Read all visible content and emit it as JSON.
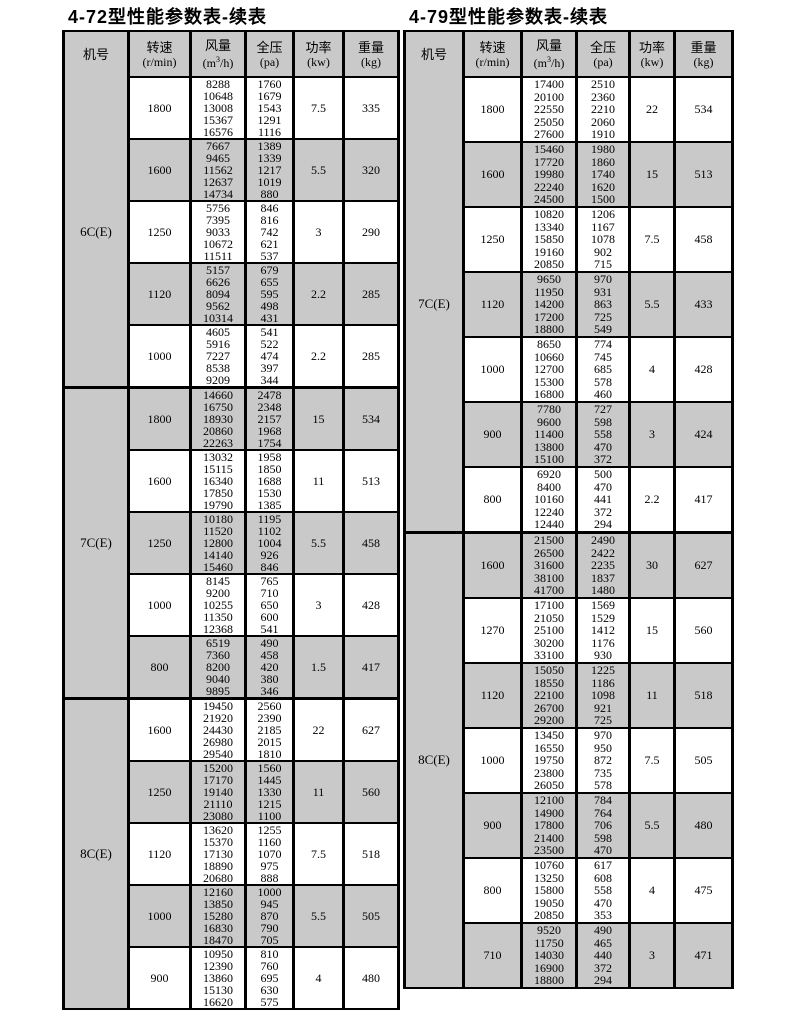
{
  "colors": {
    "shade_bg": "#c9c9c9",
    "border": "#000000",
    "text": "#000000",
    "page_bg": "#ffffff"
  },
  "tables": [
    {
      "title": "4-72型性能参数表-续表",
      "columns": [
        {
          "key": "model",
          "line1": "机号",
          "line2": ""
        },
        {
          "key": "speed",
          "line1": "转速",
          "line2": "(r/min)"
        },
        {
          "key": "flow",
          "line1": "风量",
          "line2_prefix": "(m",
          "line2_sup": "3",
          "line2_suffix": "/h)"
        },
        {
          "key": "pressure",
          "line1": "全压",
          "line2": "(pa)"
        },
        {
          "key": "power",
          "line1": "功率",
          "line2": "(kw)"
        },
        {
          "key": "weight",
          "line1": "重量",
          "line2": "(kg)"
        }
      ],
      "sections": [
        {
          "label": "6C(E)",
          "groups": [
            {
              "speed": "1800",
              "flow": [
                "8288",
                "10648",
                "13008",
                "15367",
                "16576"
              ],
              "pressure": [
                "1760",
                "1679",
                "1543",
                "1291",
                "1116"
              ],
              "power": "7.5",
              "weight": "335"
            },
            {
              "speed": "1600",
              "flow": [
                "7667",
                "9465",
                "11562",
                "12637",
                "14734"
              ],
              "pressure": [
                "1389",
                "1339",
                "1217",
                "1019",
                "880"
              ],
              "power": "5.5",
              "weight": "320"
            },
            {
              "speed": "1250",
              "flow": [
                "5756",
                "7395",
                "9033",
                "10672",
                "11511"
              ],
              "pressure": [
                "846",
                "816",
                "742",
                "621",
                "537"
              ],
              "power": "3",
              "weight": "290"
            },
            {
              "speed": "1120",
              "flow": [
                "5157",
                "6626",
                "8094",
                "9562",
                "10314"
              ],
              "pressure": [
                "679",
                "655",
                "595",
                "498",
                "431"
              ],
              "power": "2.2",
              "weight": "285"
            },
            {
              "speed": "1000",
              "flow": [
                "4605",
                "5916",
                "7227",
                "8538",
                "9209"
              ],
              "pressure": [
                "541",
                "522",
                "474",
                "397",
                "344"
              ],
              "power": "2.2",
              "weight": "285"
            }
          ]
        },
        {
          "label": "7C(E)",
          "groups": [
            {
              "speed": "1800",
              "flow": [
                "14660",
                "16750",
                "18930",
                "20860",
                "22263"
              ],
              "pressure": [
                "2478",
                "2348",
                "2157",
                "1968",
                "1754"
              ],
              "power": "15",
              "weight": "534"
            },
            {
              "speed": "1600",
              "flow": [
                "13032",
                "15115",
                "16340",
                "17850",
                "19790"
              ],
              "pressure": [
                "1958",
                "1850",
                "1688",
                "1530",
                "1385"
              ],
              "power": "11",
              "weight": "513"
            },
            {
              "speed": "1250",
              "flow": [
                "10180",
                "11520",
                "12800",
                "14140",
                "15460"
              ],
              "pressure": [
                "1195",
                "1102",
                "1004",
                "926",
                "846"
              ],
              "power": "5.5",
              "weight": "458"
            },
            {
              "speed": "1000",
              "flow": [
                "8145",
                "9200",
                "10255",
                "11350",
                "12368"
              ],
              "pressure": [
                "765",
                "710",
                "650",
                "600",
                "541"
              ],
              "power": "3",
              "weight": "428"
            },
            {
              "speed": "800",
              "flow": [
                "6519",
                "7360",
                "8200",
                "9040",
                "9895"
              ],
              "pressure": [
                "490",
                "458",
                "420",
                "380",
                "346"
              ],
              "power": "1.5",
              "weight": "417"
            }
          ]
        },
        {
          "label": "8C(E)",
          "groups": [
            {
              "speed": "1600",
              "flow": [
                "19450",
                "21920",
                "24430",
                "26980",
                "29540"
              ],
              "pressure": [
                "2560",
                "2390",
                "2185",
                "2015",
                "1810"
              ],
              "power": "22",
              "weight": "627"
            },
            {
              "speed": "1250",
              "flow": [
                "15200",
                "17170",
                "19140",
                "21110",
                "23080"
              ],
              "pressure": [
                "1560",
                "1445",
                "1330",
                "1215",
                "1100"
              ],
              "power": "11",
              "weight": "560"
            },
            {
              "speed": "1120",
              "flow": [
                "13620",
                "15370",
                "17130",
                "18890",
                "20680"
              ],
              "pressure": [
                "1255",
                "1160",
                "1070",
                "975",
                "888"
              ],
              "power": "7.5",
              "weight": "518"
            },
            {
              "speed": "1000",
              "flow": [
                "12160",
                "13850",
                "15280",
                "16830",
                "18470"
              ],
              "pressure": [
                "1000",
                "945",
                "870",
                "790",
                "705"
              ],
              "power": "5.5",
              "weight": "505"
            },
            {
              "speed": "900",
              "flow": [
                "10950",
                "12390",
                "13860",
                "15130",
                "16620"
              ],
              "pressure": [
                "810",
                "760",
                "695",
                "630",
                "575"
              ],
              "power": "4",
              "weight": "480"
            }
          ]
        }
      ]
    },
    {
      "title": "4-79型性能参数表-续表",
      "columns": [
        {
          "key": "model",
          "line1": "机号",
          "line2": ""
        },
        {
          "key": "speed",
          "line1": "转速",
          "line2": "(r/min)"
        },
        {
          "key": "flow",
          "line1": "风量",
          "line2_prefix": "(m",
          "line2_sup": "3",
          "line2_suffix": "/h)"
        },
        {
          "key": "pressure",
          "line1": "全压",
          "line2": "(pa)"
        },
        {
          "key": "power",
          "line1": "功率",
          "line2": "(kw)"
        },
        {
          "key": "weight",
          "line1": "重量",
          "line2": "(kg)"
        }
      ],
      "sections": [
        {
          "label": "7C(E)",
          "groups": [
            {
              "speed": "1800",
              "flow": [
                "17400",
                "20100",
                "22550",
                "25050",
                "27600"
              ],
              "pressure": [
                "2510",
                "2360",
                "2210",
                "2060",
                "1910"
              ],
              "power": "22",
              "weight": "534"
            },
            {
              "speed": "1600",
              "flow": [
                "15460",
                "17720",
                "19980",
                "22240",
                "24500"
              ],
              "pressure": [
                "1980",
                "1860",
                "1740",
                "1620",
                "1500"
              ],
              "power": "15",
              "weight": "513"
            },
            {
              "speed": "1250",
              "flow": [
                "10820",
                "13340",
                "15850",
                "19160",
                "20850"
              ],
              "pressure": [
                "1206",
                "1167",
                "1078",
                "902",
                "715"
              ],
              "power": "7.5",
              "weight": "458"
            },
            {
              "speed": "1120",
              "flow": [
                "9650",
                "11950",
                "14200",
                "17200",
                "18800"
              ],
              "pressure": [
                "970",
                "931",
                "863",
                "725",
                "549"
              ],
              "power": "5.5",
              "weight": "433"
            },
            {
              "speed": "1000",
              "flow": [
                "8650",
                "10660",
                "12700",
                "15300",
                "16800"
              ],
              "pressure": [
                "774",
                "745",
                "685",
                "578",
                "460"
              ],
              "power": "4",
              "weight": "428"
            },
            {
              "speed": "900",
              "flow": [
                "7780",
                "9600",
                "11400",
                "13800",
                "15100"
              ],
              "pressure": [
                "727",
                "598",
                "558",
                "470",
                "372"
              ],
              "power": "3",
              "weight": "424"
            },
            {
              "speed": "800",
              "flow": [
                "6920",
                "8400",
                "10160",
                "12240",
                "12440"
              ],
              "pressure": [
                "500",
                "470",
                "441",
                "372",
                "294"
              ],
              "power": "2.2",
              "weight": "417"
            }
          ]
        },
        {
          "label": "8C(E)",
          "groups": [
            {
              "speed": "1600",
              "flow": [
                "21500",
                "26500",
                "31600",
                "38100",
                "41700"
              ],
              "pressure": [
                "2490",
                "2422",
                "2235",
                "1837",
                "1480"
              ],
              "power": "30",
              "weight": "627"
            },
            {
              "speed": "1270",
              "flow": [
                "17100",
                "21050",
                "25100",
                "30200",
                "33100"
              ],
              "pressure": [
                "1569",
                "1529",
                "1412",
                "1176",
                "930"
              ],
              "power": "15",
              "weight": "560"
            },
            {
              "speed": "1120",
              "flow": [
                "15050",
                "18550",
                "22100",
                "26700",
                "29200"
              ],
              "pressure": [
                "1225",
                "1186",
                "1098",
                "921",
                "725"
              ],
              "power": "11",
              "weight": "518"
            },
            {
              "speed": "1000",
              "flow": [
                "13450",
                "16550",
                "19750",
                "23800",
                "26050"
              ],
              "pressure": [
                "970",
                "950",
                "872",
                "735",
                "578"
              ],
              "power": "7.5",
              "weight": "505"
            },
            {
              "speed": "900",
              "flow": [
                "12100",
                "14900",
                "17800",
                "21400",
                "23500"
              ],
              "pressure": [
                "784",
                "764",
                "706",
                "598",
                "470"
              ],
              "power": "5.5",
              "weight": "480"
            },
            {
              "speed": "800",
              "flow": [
                "10760",
                "13250",
                "15800",
                "19050",
                "20850"
              ],
              "pressure": [
                "617",
                "608",
                "558",
                "470",
                "353"
              ],
              "power": "4",
              "weight": "475"
            },
            {
              "speed": "710",
              "flow": [
                "9520",
                "11750",
                "14030",
                "16900",
                "18800"
              ],
              "pressure": [
                "490",
                "465",
                "440",
                "372",
                "294"
              ],
              "power": "3",
              "weight": "471"
            }
          ]
        }
      ]
    }
  ]
}
